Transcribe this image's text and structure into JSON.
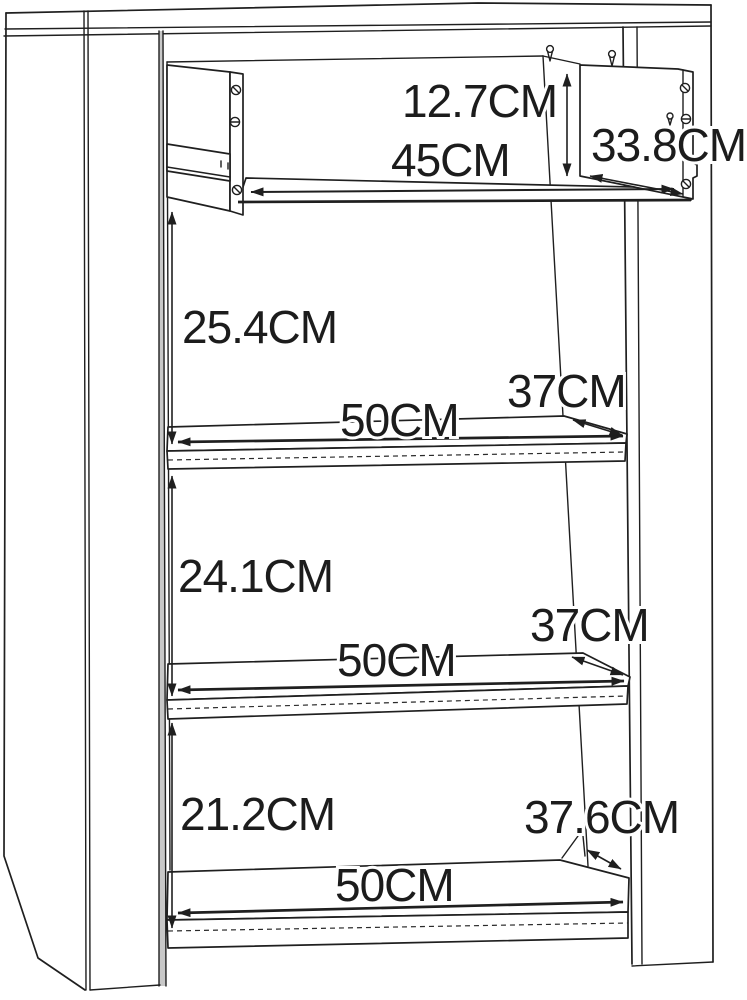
{
  "figure": {
    "type": "furniture-dimension-diagram",
    "unit": "CM",
    "colors": {
      "line": "#1f1f1f",
      "background": "#ffffff",
      "panel_edge_shade": "#c8c8c8"
    },
    "dims": {
      "drawer_height": "12.7CM",
      "drawer_width": "45CM",
      "drawer_depth": "33.8CM",
      "upper_section_height": "25.4CM",
      "upper_shelf_width": "50CM",
      "upper_shelf_depth": "37CM",
      "middle_section_height": "24.1CM",
      "middle_shelf_width": "50CM",
      "middle_shelf_depth": "37CM",
      "lower_section_height": "21.2CM",
      "bottom_shelf_width": "50CM",
      "bottom_shelf_depth": "37.6CM"
    }
  }
}
